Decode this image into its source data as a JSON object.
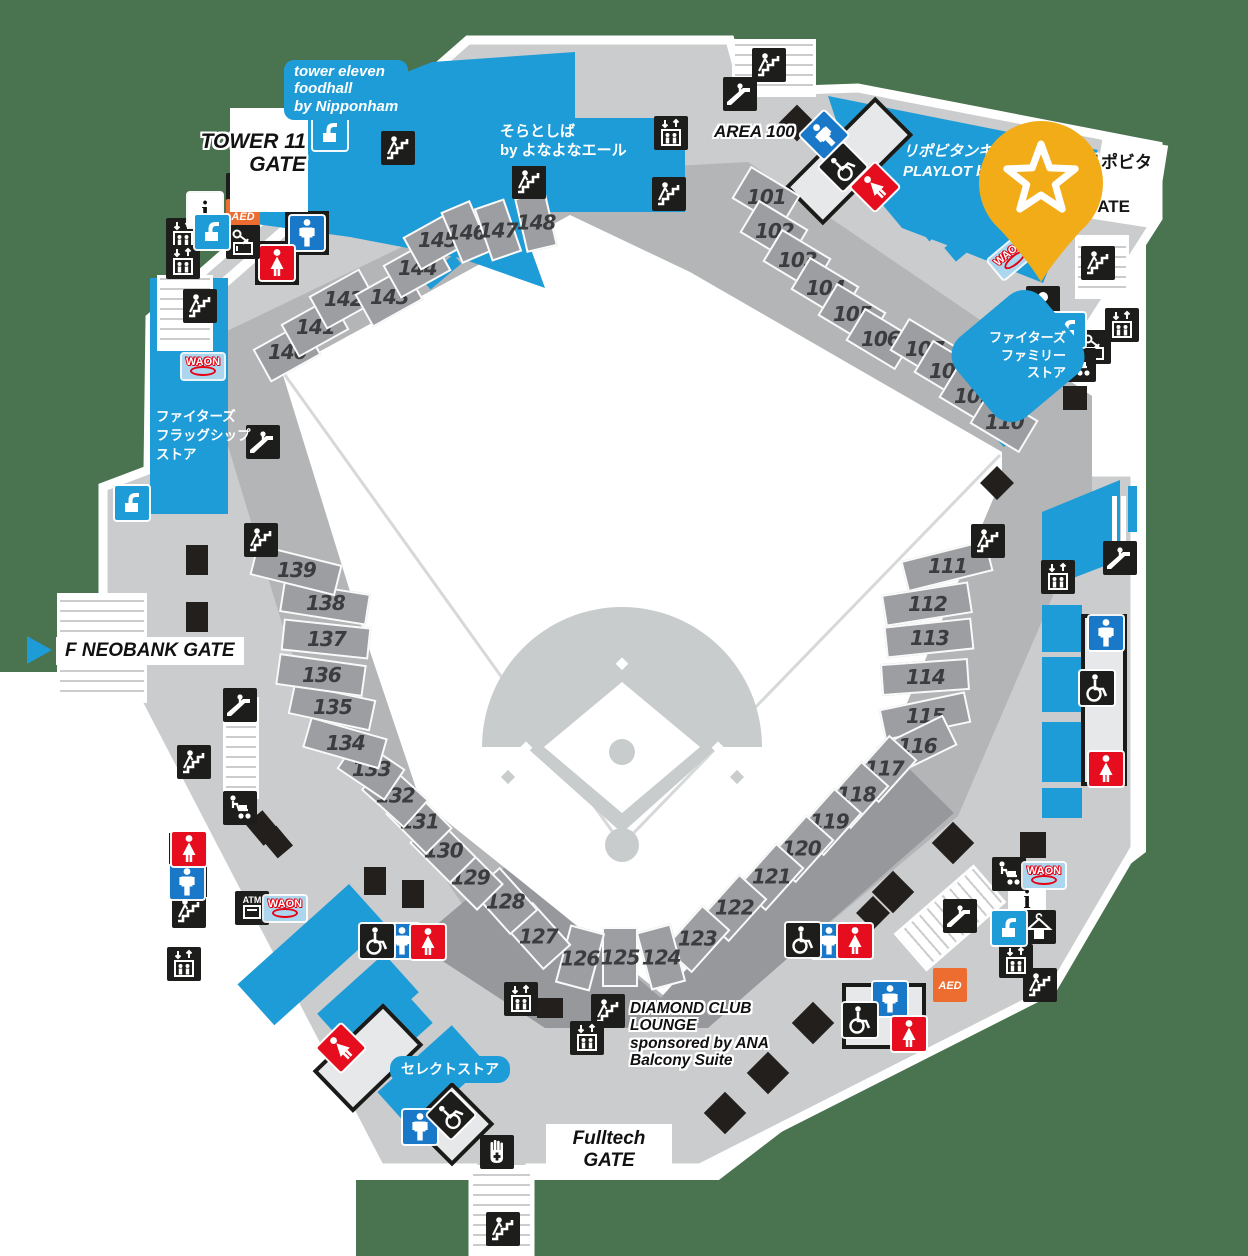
{
  "map": {
    "colors": {
      "green": "#4a7350",
      "concourse": "#cbcccd",
      "bowl": "#b3b5b6",
      "bowl_dark": "#96989b",
      "section": "#9c9ea1",
      "blue": "#1e9cd7",
      "men_blue": "#1a78c8",
      "women_red": "#e60d1f",
      "aed_orange": "#ed6c30",
      "pin_yellow": "#f2ac18",
      "waon_bg": "#abd6ee",
      "black": "#1d1d1b"
    },
    "gates": {
      "tower11": {
        "label": "TOWER 11\nGATE"
      },
      "f_neobank": {
        "label": "F NEOBANK GATE"
      },
      "fulltech": {
        "label": "Fulltech GATE"
      },
      "lipovitan": {
        "label": "リポビタン\nGATE"
      }
    },
    "areas": {
      "area100": "AREA 100",
      "diamond_club": "DIAMOND CLUB\nLOUNGE\nsponsored by ANA\nBalcony Suite"
    },
    "stores": {
      "foodhall": "tower eleven\nfoodhall\nby Nipponham",
      "soratoshiba": "そらとしば\nby よなよなエール",
      "playlot": "リポビタンキ\nPLAYLOT by",
      "family_store": "ファイターズ\nファミリー\nストア",
      "flagship_store": "ファイターズ\nフラッグシップ\nストア",
      "select_store": "セレクトストア"
    },
    "waon_label": "WAON",
    "sections": [
      {
        "n": "101",
        "x": 766,
        "y": 197,
        "r": 31
      },
      {
        "n": "102",
        "x": 774,
        "y": 231,
        "r": 31
      },
      {
        "n": "103",
        "x": 797,
        "y": 260,
        "r": 31
      },
      {
        "n": "104",
        "x": 825,
        "y": 288,
        "r": 31
      },
      {
        "n": "105",
        "x": 852,
        "y": 314,
        "r": 31
      },
      {
        "n": "106",
        "x": 880,
        "y": 339,
        "r": 31
      },
      {
        "n": "107",
        "x": 924,
        "y": 349,
        "r": 31
      },
      {
        "n": "108",
        "x": 948,
        "y": 371,
        "r": 31
      },
      {
        "n": "109",
        "x": 973,
        "y": 396,
        "r": 31
      },
      {
        "n": "110",
        "x": 1004,
        "y": 422,
        "r": 31
      },
      {
        "n": "111",
        "x": 947,
        "y": 566,
        "r": -14,
        "w": 88,
        "h": 32
      },
      {
        "n": "112",
        "x": 927,
        "y": 604,
        "r": -9,
        "w": 88,
        "h": 32
      },
      {
        "n": "113",
        "x": 929,
        "y": 638,
        "r": -6,
        "w": 88,
        "h": 32
      },
      {
        "n": "114",
        "x": 925,
        "y": 677,
        "r": -4,
        "w": 88,
        "h": 32
      },
      {
        "n": "115",
        "x": 925,
        "y": 716,
        "r": -12,
        "w": 88,
        "h": 32
      },
      {
        "n": "116",
        "x": 917,
        "y": 746,
        "r": -26,
        "w": 74,
        "h": 34
      },
      {
        "n": "117",
        "x": 884,
        "y": 769,
        "r": -48
      },
      {
        "n": "118",
        "x": 856,
        "y": 795,
        "r": -48
      },
      {
        "n": "119",
        "x": 829,
        "y": 822,
        "r": -48
      },
      {
        "n": "120",
        "x": 801,
        "y": 849,
        "r": -48
      },
      {
        "n": "121",
        "x": 771,
        "y": 877,
        "r": -48
      },
      {
        "n": "122",
        "x": 734,
        "y": 908,
        "r": -48
      },
      {
        "n": "123",
        "x": 697,
        "y": 939,
        "r": -48
      },
      {
        "n": "124",
        "x": 661,
        "y": 957,
        "r": 75,
        "w": 60,
        "h": 36
      },
      {
        "n": "125",
        "x": 620,
        "y": 957,
        "r": 90,
        "w": 60,
        "h": 36
      },
      {
        "n": "126",
        "x": 580,
        "y": 958,
        "r": 105,
        "w": 60,
        "h": 36
      },
      {
        "n": "127",
        "x": 538,
        "y": 936,
        "r": 48
      },
      {
        "n": "128",
        "x": 505,
        "y": 901,
        "r": 48
      },
      {
        "n": "129",
        "x": 470,
        "y": 877,
        "r": 45
      },
      {
        "n": "130",
        "x": 443,
        "y": 850,
        "r": 45
      },
      {
        "n": "131",
        "x": 419,
        "y": 821,
        "r": 45
      },
      {
        "n": "132",
        "x": 395,
        "y": 795,
        "r": 42
      },
      {
        "n": "133",
        "x": 371,
        "y": 769,
        "r": 34
      },
      {
        "n": "134",
        "x": 345,
        "y": 743,
        "r": 16,
        "w": 80,
        "h": 32
      },
      {
        "n": "135",
        "x": 332,
        "y": 707,
        "r": 12,
        "w": 84,
        "h": 32
      },
      {
        "n": "136",
        "x": 321,
        "y": 675,
        "r": 8,
        "w": 88,
        "h": 32
      },
      {
        "n": "137",
        "x": 326,
        "y": 639,
        "r": 6,
        "w": 88,
        "h": 32
      },
      {
        "n": "138",
        "x": 325,
        "y": 603,
        "r": 9,
        "w": 88,
        "h": 32
      },
      {
        "n": "139",
        "x": 296,
        "y": 570,
        "r": 14,
        "w": 88,
        "h": 32
      },
      {
        "n": "140",
        "x": 287,
        "y": 352,
        "r": -29
      },
      {
        "n": "141",
        "x": 315,
        "y": 327,
        "r": -29
      },
      {
        "n": "142",
        "x": 343,
        "y": 299,
        "r": -29
      },
      {
        "n": "143",
        "x": 389,
        "y": 297,
        "r": -29
      },
      {
        "n": "144",
        "x": 417,
        "y": 268,
        "r": -29
      },
      {
        "n": "145",
        "x": 437,
        "y": 240,
        "r": -29
      },
      {
        "n": "146",
        "x": 466,
        "y": 232,
        "r": 67,
        "w": 56,
        "h": 32
      },
      {
        "n": "147",
        "x": 498,
        "y": 230,
        "r": 71,
        "w": 56,
        "h": 32
      },
      {
        "n": "148",
        "x": 536,
        "y": 222,
        "r": 77,
        "w": 56,
        "h": 32
      }
    ],
    "icons": [
      {
        "t": "stairs",
        "x": 398,
        "y": 148
      },
      {
        "t": "stairs",
        "x": 769,
        "y": 65
      },
      {
        "t": "stairs",
        "x": 669,
        "y": 194
      },
      {
        "t": "stairs",
        "x": 529,
        "y": 182
      },
      {
        "t": "stairs",
        "x": 200,
        "y": 306
      },
      {
        "t": "stairs",
        "x": 1098,
        "y": 263
      },
      {
        "t": "stairs",
        "x": 988,
        "y": 541
      },
      {
        "t": "stairs",
        "x": 261,
        "y": 540
      },
      {
        "t": "stairs",
        "x": 194,
        "y": 762
      },
      {
        "t": "stairs",
        "x": 189,
        "y": 911
      },
      {
        "t": "stairs",
        "x": 608,
        "y": 1011
      },
      {
        "t": "stairs",
        "x": 1040,
        "y": 985
      },
      {
        "t": "stairs",
        "x": 503,
        "y": 1229
      },
      {
        "t": "escalator",
        "x": 740,
        "y": 94
      },
      {
        "t": "escalator",
        "x": 263,
        "y": 442
      },
      {
        "t": "escalator",
        "x": 240,
        "y": 705
      },
      {
        "t": "escalator",
        "x": 1120,
        "y": 558
      },
      {
        "t": "escalator",
        "x": 960,
        "y": 916
      },
      {
        "t": "elevator",
        "x": 183,
        "y": 235
      },
      {
        "t": "elevator",
        "x": 183,
        "y": 262
      },
      {
        "t": "elevator",
        "x": 671,
        "y": 133
      },
      {
        "t": "elevator",
        "x": 1122,
        "y": 325
      },
      {
        "t": "elevator",
        "x": 1058,
        "y": 577
      },
      {
        "t": "elevator",
        "x": 184,
        "y": 964
      },
      {
        "t": "elevator",
        "x": 521,
        "y": 999
      },
      {
        "t": "elevator",
        "x": 587,
        "y": 1038
      },
      {
        "t": "elevator",
        "x": 1016,
        "y": 961
      },
      {
        "t": "men",
        "x": 307,
        "y": 233
      },
      {
        "t": "men",
        "x": 824,
        "y": 135,
        "r": -45
      },
      {
        "t": "men",
        "x": 1106,
        "y": 633
      },
      {
        "t": "men",
        "x": 829,
        "y": 941
      },
      {
        "t": "men",
        "x": 890,
        "y": 999
      },
      {
        "t": "men",
        "x": 187,
        "y": 882
      },
      {
        "t": "men",
        "x": 402,
        "y": 941
      },
      {
        "t": "men",
        "x": 420,
        "y": 1127
      },
      {
        "t": "women",
        "x": 277,
        "y": 263
      },
      {
        "t": "women",
        "x": 875,
        "y": 187,
        "r": -45
      },
      {
        "t": "women",
        "x": 1106,
        "y": 769
      },
      {
        "t": "women",
        "x": 855,
        "y": 941
      },
      {
        "t": "women",
        "x": 909,
        "y": 1034
      },
      {
        "t": "women",
        "x": 189,
        "y": 849
      },
      {
        "t": "women",
        "x": 428,
        "y": 942
      },
      {
        "t": "women",
        "x": 341,
        "y": 1048,
        "r": -45
      },
      {
        "t": "wheelchair",
        "x": 843,
        "y": 167,
        "r": -45
      },
      {
        "t": "wheelchair",
        "x": 1097,
        "y": 688
      },
      {
        "t": "wheelchair",
        "x": 803,
        "y": 940
      },
      {
        "t": "wheelchair",
        "x": 860,
        "y": 1020
      },
      {
        "t": "wheelchair",
        "x": 377,
        "y": 941
      },
      {
        "t": "wheelchair",
        "x": 451,
        "y": 1115,
        "r": -45
      },
      {
        "t": "atm",
        "x": 243,
        "y": 190
      },
      {
        "t": "atm",
        "x": 252,
        "y": 908
      },
      {
        "t": "aed",
        "x": 243,
        "y": 216
      },
      {
        "t": "aed",
        "x": 950,
        "y": 985
      },
      {
        "t": "info",
        "x": 205,
        "y": 210
      },
      {
        "t": "info",
        "x": 1027,
        "y": 899
      },
      {
        "t": "locker",
        "x": 243,
        "y": 242
      },
      {
        "t": "locker",
        "x": 1094,
        "y": 347
      },
      {
        "t": "cloak",
        "x": 1039,
        "y": 927
      },
      {
        "t": "baby",
        "x": 1043,
        "y": 303
      },
      {
        "t": "stroller",
        "x": 240,
        "y": 808
      },
      {
        "t": "stroller",
        "x": 1079,
        "y": 365
      },
      {
        "t": "stroller",
        "x": 1009,
        "y": 874
      },
      {
        "t": "water",
        "x": 212,
        "y": 232
      },
      {
        "t": "water",
        "x": 330,
        "y": 133
      },
      {
        "t": "water",
        "x": 132,
        "y": 503
      },
      {
        "t": "water",
        "x": 1068,
        "y": 330
      },
      {
        "t": "water",
        "x": 1009,
        "y": 928
      },
      {
        "t": "hand",
        "x": 497,
        "y": 1152
      },
      {
        "t": "waon",
        "x": 203,
        "y": 366
      },
      {
        "t": "waon",
        "x": 285,
        "y": 908
      },
      {
        "t": "waon",
        "x": 1012,
        "y": 256,
        "r": -40
      },
      {
        "t": "waon",
        "x": 1044,
        "y": 875
      }
    ],
    "decor": {
      "frames": [
        [
          849,
          161,
          128,
          54,
          -45
        ],
        [
          1104,
          700,
          46,
          172,
          0
        ],
        [
          829,
          941,
          86,
          36,
          0
        ],
        [
          884,
          1016,
          84,
          66,
          0
        ],
        [
          188,
          865,
          38,
          64,
          0
        ],
        [
          402,
          941,
          86,
          34,
          0
        ],
        [
          368,
          1058,
          98,
          58,
          -44
        ],
        [
          452,
          1124,
          60,
          60,
          -45
        ],
        [
          307,
          233,
          44,
          44,
          0
        ],
        [
          277,
          263,
          44,
          44,
          0
        ]
      ],
      "shafts": [
        [
          735,
          42,
          78,
          52,
          0
        ],
        [
          1078,
          238,
          48,
          58,
          0
        ],
        [
          160,
          278,
          50,
          70,
          0
        ],
        [
          60,
          596,
          84,
          104,
          0
        ],
        [
          473,
          1168,
          57,
          86,
          0
        ],
        [
          226,
          700,
          30,
          96,
          0
        ],
        [
          928,
          868,
          44,
          100,
          49
        ]
      ],
      "squares": [
        [
          197,
          560,
          22,
          30,
          0
        ],
        [
          197,
          617,
          22,
          30,
          0
        ],
        [
          263,
          828,
          22,
          28,
          -40
        ],
        [
          277,
          842,
          20,
          26,
          -40
        ],
        [
          375,
          881,
          22,
          28,
          0
        ],
        [
          413,
          894,
          22,
          28,
          0
        ],
        [
          550,
          1008,
          26,
          20,
          0
        ],
        [
          1033,
          845,
          26,
          26,
          0
        ],
        [
          1075,
          398,
          24,
          24,
          0
        ]
      ],
      "diamonds": [
        [
          797,
          123,
          26
        ],
        [
          1032,
          390,
          26
        ],
        [
          997,
          483,
          24
        ],
        [
          953,
          843,
          30
        ],
        [
          893,
          892,
          30
        ],
        [
          873,
          913,
          24
        ],
        [
          813,
          1023,
          30
        ],
        [
          768,
          1073,
          30
        ],
        [
          725,
          1113,
          30
        ]
      ]
    }
  }
}
